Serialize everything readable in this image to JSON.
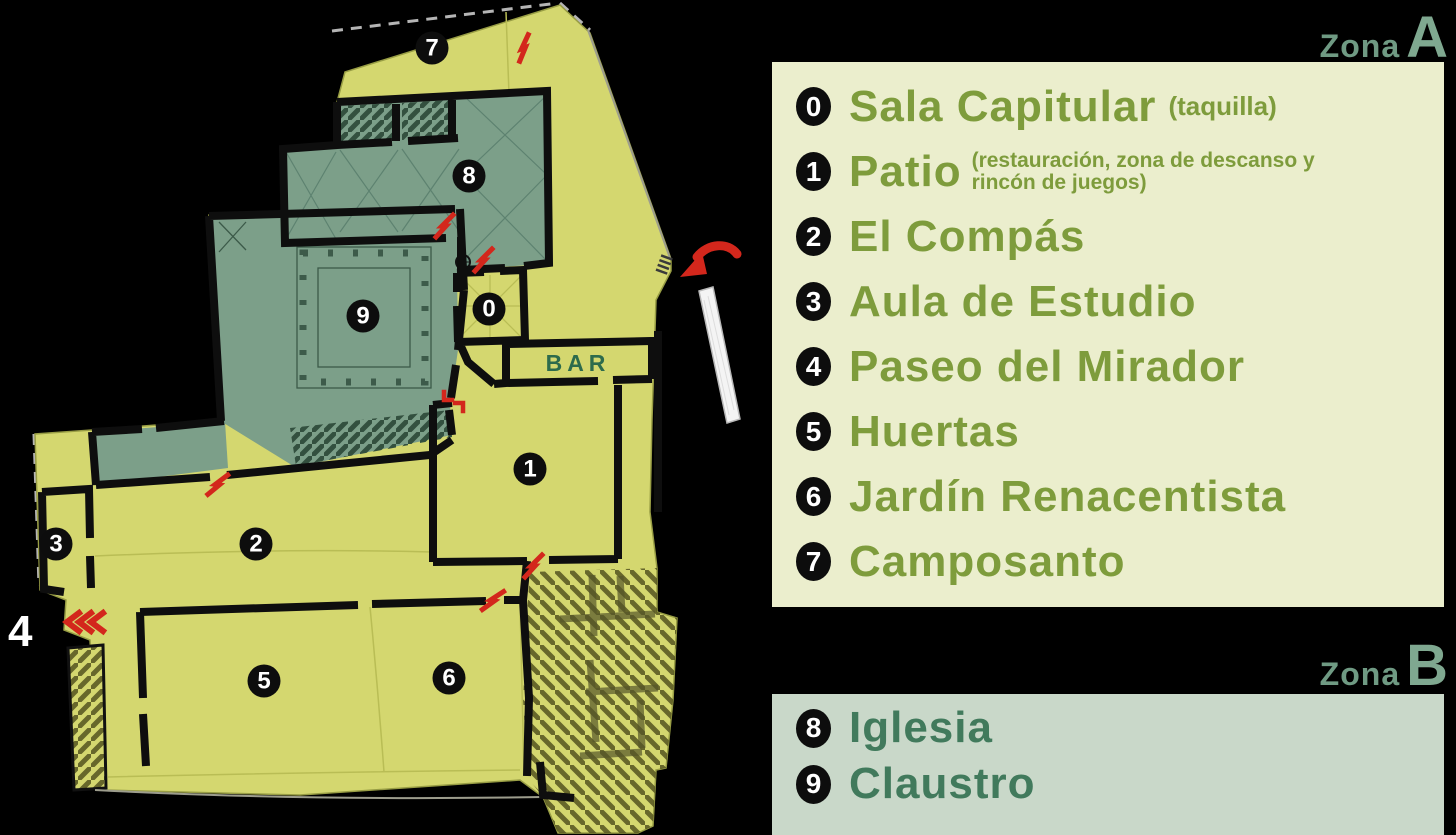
{
  "colors": {
    "page_bg": "#000000",
    "map_yellow": "#d4d76f",
    "map_sage": "#7c9f89",
    "wall_black": "#0e0e0e",
    "door_red": "#d3271c",
    "panel_a_bg": "#ebeecd",
    "panel_b_bg": "#c9d8c9",
    "text_olive": "#7e9c3c",
    "text_teal": "#417a5c",
    "zona_word_color": "#6f9a83",
    "zona_letter_color": "#7fa890",
    "bar_green": "#2d6b4c",
    "badge_black": "#0d0d0d"
  },
  "map": {
    "bar_label": "BAR",
    "exterior_label": "4",
    "badges": [
      "0",
      "1",
      "2",
      "3",
      "5",
      "6",
      "7",
      "8",
      "9"
    ]
  },
  "legend": {
    "zone_a": {
      "zona_word": "Zona",
      "zone_letter": "A",
      "items": [
        {
          "num": "0",
          "label": "Sala Capitular",
          "note": "(taquilla)"
        },
        {
          "num": "1",
          "label": "Patio",
          "note": "(restauración, zona de descanso y rincón de juegos)"
        },
        {
          "num": "2",
          "label": "El Compás",
          "note": ""
        },
        {
          "num": "3",
          "label": "Aula de Estudio",
          "note": ""
        },
        {
          "num": "4",
          "label": "Paseo del Mirador",
          "note": ""
        },
        {
          "num": "5",
          "label": "Huertas",
          "note": ""
        },
        {
          "num": "6",
          "label": "Jardín Renacentista",
          "note": ""
        },
        {
          "num": "7",
          "label": "Camposanto",
          "note": ""
        }
      ]
    },
    "zone_b": {
      "zona_word": "Zona",
      "zone_letter": "B",
      "items": [
        {
          "num": "8",
          "label": "Iglesia",
          "note": ""
        },
        {
          "num": "9",
          "label": "Claustro",
          "note": ""
        }
      ]
    }
  }
}
